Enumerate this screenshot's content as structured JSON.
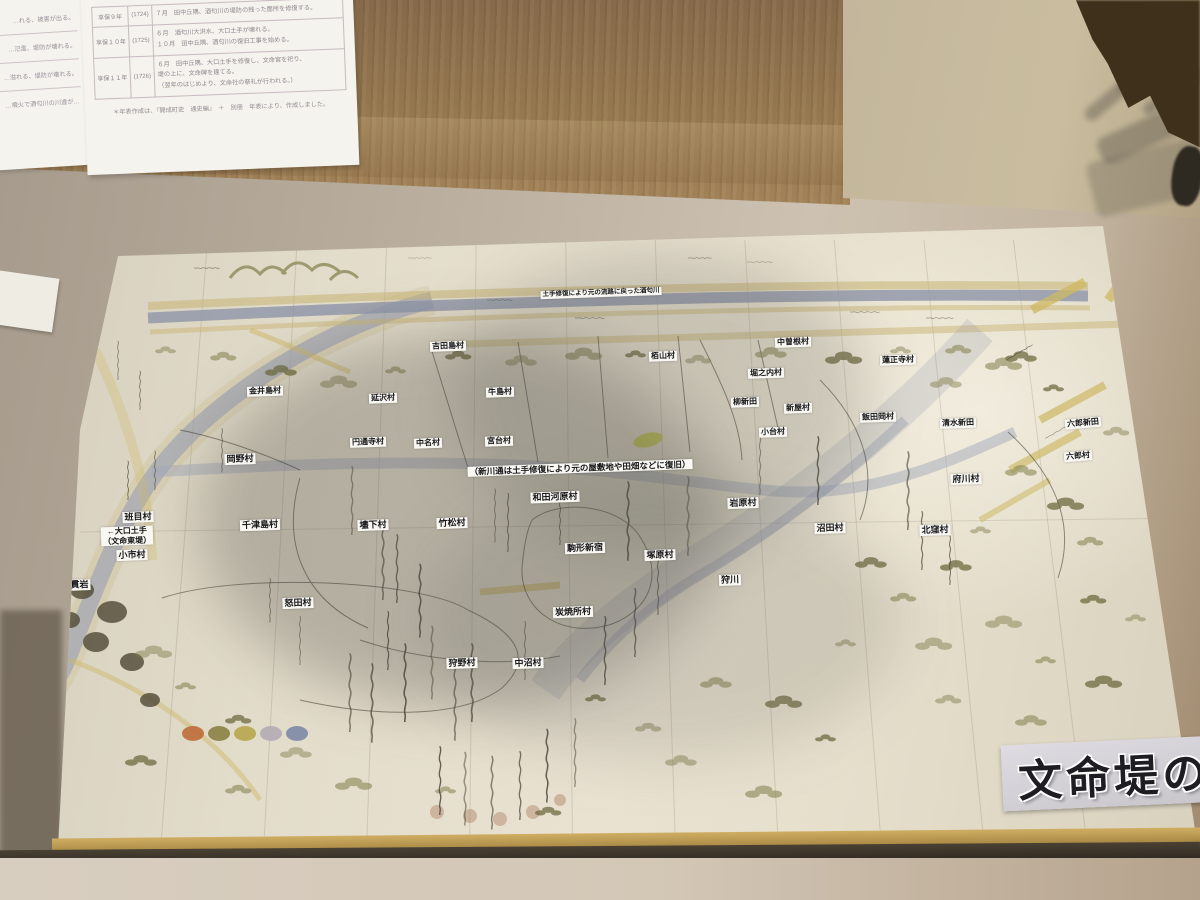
{
  "chronology_panel": {
    "rows": [
      {
        "era": "享保９年",
        "year": "(1724)",
        "text": "７月　田中丘隅、酒匂川の堤防の残った箇所を修復する。"
      },
      {
        "era": "享保１０年",
        "year": "(1725)",
        "text": "６月　酒匂川大洪水、大口土手が壊れる。\n１０月　田中丘隅、酒匂川の復旧工事を始める。"
      },
      {
        "era": "享保１１年",
        "year": "(1726)",
        "text": "６月　田中丘隅、大口土手を修復し、文命宮を祀り、\n堤の上に、文命碑を建てる。\n（翌年のはじめより、文命社の祭礼が行われる。）"
      }
    ],
    "caption": "＊年表作成は、『開成町史　通史編』　＋　別冊　年表により、作成しました。"
  },
  "left_panel": {
    "fragments": [
      "…れる、被害が出る。",
      "…氾濫、堤防が壊れる。",
      "…溢れる、堤防が壊れる。",
      "…噴火で酒匂川の川違が…"
    ]
  },
  "exhibit_sign": {
    "text": "文命堤の"
  },
  "map": {
    "annotations": [
      {
        "t": "土手修復により元の流路に戻った酒匂川",
        "x": 601,
        "y": 293,
        "fs": 6.5
      },
      {
        "t": "（新川通は土手修復により元の屋敷地や田畑などに復旧）",
        "x": 580,
        "y": 468,
        "fs": 8.5
      }
    ],
    "village_labels": [
      {
        "t": "吉田島村",
        "x": 448,
        "y": 346,
        "fs": 8
      },
      {
        "t": "栢山村",
        "x": 663,
        "y": 356,
        "fs": 8
      },
      {
        "t": "中曽根村",
        "x": 793,
        "y": 342,
        "fs": 8
      },
      {
        "t": "蓮正寺村",
        "x": 898,
        "y": 360,
        "fs": 8
      },
      {
        "t": "堀之内村",
        "x": 766,
        "y": 373,
        "fs": 8
      },
      {
        "t": "金井島村",
        "x": 265,
        "y": 391,
        "fs": 8
      },
      {
        "t": "延沢村",
        "x": 383,
        "y": 398,
        "fs": 8
      },
      {
        "t": "牛島村",
        "x": 500,
        "y": 392,
        "fs": 8
      },
      {
        "t": "柳新田",
        "x": 745,
        "y": 402,
        "fs": 8
      },
      {
        "t": "新屋村",
        "x": 798,
        "y": 408,
        "fs": 8
      },
      {
        "t": "飯田岡村",
        "x": 878,
        "y": 417,
        "fs": 8
      },
      {
        "t": "清水新田",
        "x": 958,
        "y": 423,
        "fs": 8
      },
      {
        "t": "小台村",
        "x": 773,
        "y": 432,
        "fs": 8
      },
      {
        "t": "六郎新田",
        "x": 1083,
        "y": 423,
        "fs": 8,
        "r": -5
      },
      {
        "t": "六郎村",
        "x": 1078,
        "y": 456,
        "fs": 8,
        "r": -5
      },
      {
        "t": "岡野村",
        "x": 240,
        "y": 459,
        "fs": 9
      },
      {
        "t": "円通寺村",
        "x": 368,
        "y": 442,
        "fs": 8
      },
      {
        "t": "中名村",
        "x": 428,
        "y": 443,
        "fs": 8
      },
      {
        "t": "宮台村",
        "x": 499,
        "y": 441,
        "fs": 8
      },
      {
        "t": "府川村",
        "x": 966,
        "y": 479,
        "fs": 9
      },
      {
        "t": "和田河原村",
        "x": 555,
        "y": 497,
        "fs": 9
      },
      {
        "t": "岩原村",
        "x": 743,
        "y": 503,
        "fs": 9
      },
      {
        "t": "班目村",
        "x": 138,
        "y": 517,
        "fs": 9
      },
      {
        "t": "千津島村",
        "x": 260,
        "y": 525,
        "fs": 9
      },
      {
        "t": "壗下村",
        "x": 373,
        "y": 525,
        "fs": 9
      },
      {
        "t": "竹松村",
        "x": 452,
        "y": 523,
        "fs": 9
      },
      {
        "t": "沼田村",
        "x": 830,
        "y": 528,
        "fs": 9
      },
      {
        "t": "北窪村",
        "x": 935,
        "y": 530,
        "fs": 9
      },
      {
        "t": "←大口土手\n（文命東堤）",
        "x": 127,
        "y": 536,
        "fs": 8
      },
      {
        "t": "小市村",
        "x": 132,
        "y": 555,
        "fs": 9
      },
      {
        "t": "駒形新宿",
        "x": 585,
        "y": 548,
        "fs": 9
      },
      {
        "t": "塚原村",
        "x": 660,
        "y": 555,
        "fs": 9
      },
      {
        "t": "狩川",
        "x": 730,
        "y": 580,
        "fs": 9
      },
      {
        "t": "千貫岩",
        "x": 75,
        "y": 585,
        "fs": 9
      },
      {
        "t": "怒田村",
        "x": 298,
        "y": 603,
        "fs": 9
      },
      {
        "t": "炭焼所村",
        "x": 573,
        "y": 612,
        "fs": 9
      },
      {
        "t": "狩野村",
        "x": 462,
        "y": 663,
        "fs": 9
      },
      {
        "t": "中沼村",
        "x": 528,
        "y": 663,
        "fs": 9
      }
    ],
    "legend_colors": [
      "#bf6b38",
      "#8a8142",
      "#b8a64e",
      "#b2acb5",
      "#7e88a6"
    ],
    "river_color": "#8e95a9",
    "road_color": "#cdb863",
    "paper_color": "#e6dfcc"
  }
}
